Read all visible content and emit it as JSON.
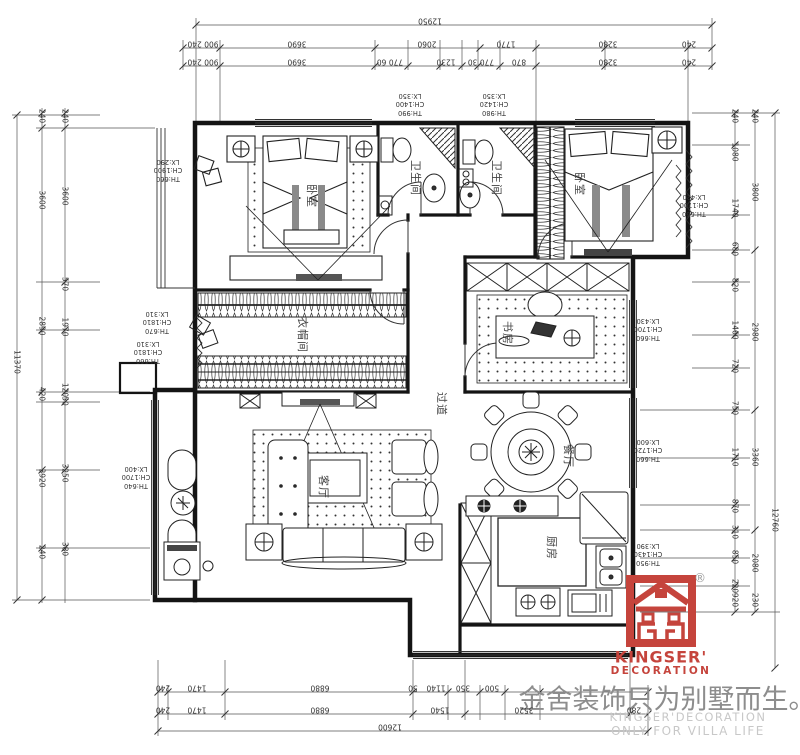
{
  "rooms": [
    {
      "label": "卧室",
      "x": 312,
      "y": 196
    },
    {
      "label": "卫生间",
      "x": 416,
      "y": 178
    },
    {
      "label": "卫生间",
      "x": 497,
      "y": 178
    },
    {
      "label": "卧室",
      "x": 580,
      "y": 184
    },
    {
      "label": "衣帽间",
      "x": 303,
      "y": 335
    },
    {
      "label": "过道",
      "x": 442,
      "y": 404
    },
    {
      "label": "书房",
      "x": 508,
      "y": 333
    },
    {
      "label": "客厅",
      "x": 324,
      "y": 487
    },
    {
      "label": "餐厅",
      "x": 569,
      "y": 456
    },
    {
      "label": "厨房",
      "x": 552,
      "y": 548
    }
  ],
  "annotations": [
    {
      "x": 168,
      "y": 170,
      "lines": [
        "TH:660",
        "CH:1900",
        "LX:290"
      ]
    },
    {
      "x": 410,
      "y": 104,
      "lines": [
        "TH:990",
        "CH:1400",
        "LX:350"
      ]
    },
    {
      "x": 494,
      "y": 104,
      "lines": [
        "TH:980",
        "CH:1420",
        "LX:350"
      ]
    },
    {
      "x": 694,
      "y": 205,
      "lines": [
        "TH:660",
        "CH:1700",
        "LX:420"
      ]
    },
    {
      "x": 157,
      "y": 322,
      "lines": [
        "TH:670",
        "CH:1810",
        "LX:310"
      ]
    },
    {
      "x": 148,
      "y": 352,
      "lines": [
        "TH:660",
        "CH:1810",
        "LX:310"
      ]
    },
    {
      "x": 648,
      "y": 329,
      "lines": [
        "TH:660",
        "CH:1700",
        "LX:430"
      ]
    },
    {
      "x": 136,
      "y": 477,
      "lines": [
        "TH:640",
        "CH:1700",
        "LX:400"
      ]
    },
    {
      "x": 648,
      "y": 450,
      "lines": [
        "TH:660",
        "CH:1720",
        "LX:600"
      ]
    },
    {
      "x": 648,
      "y": 554,
      "lines": [
        "TH:950",
        "CH:1430",
        "LX:390"
      ]
    }
  ],
  "dims": {
    "top": [
      {
        "t": "12950",
        "x": 430,
        "y": 21
      },
      {
        "t": "900 240",
        "x": 203,
        "y": 44
      },
      {
        "t": "3690",
        "x": 297,
        "y": 44
      },
      {
        "t": "2060",
        "x": 427,
        "y": 44
      },
      {
        "t": "1770",
        "x": 506,
        "y": 44
      },
      {
        "t": "3280",
        "x": 608,
        "y": 44
      },
      {
        "t": "240",
        "x": 689,
        "y": 44
      },
      {
        "t": "900 240",
        "x": 203,
        "y": 62
      },
      {
        "t": "3690",
        "x": 297,
        "y": 62
      },
      {
        "t": "770 60",
        "x": 390,
        "y": 62
      },
      {
        "t": "1230",
        "x": 446,
        "y": 62
      },
      {
        "t": "770 30",
        "x": 481,
        "y": 62
      },
      {
        "t": "870",
        "x": 519,
        "y": 62
      },
      {
        "t": "3280",
        "x": 608,
        "y": 62
      },
      {
        "t": "240",
        "x": 689,
        "y": 62
      }
    ],
    "bottom": [
      {
        "t": "12600",
        "x": 390,
        "y": 727
      },
      {
        "t": "240",
        "x": 163,
        "y": 688
      },
      {
        "t": "1470",
        "x": 197,
        "y": 688
      },
      {
        "t": "6880",
        "x": 320,
        "y": 688
      },
      {
        "t": "50",
        "x": 413,
        "y": 688
      },
      {
        "t": "1140",
        "x": 436,
        "y": 688
      },
      {
        "t": "350",
        "x": 463,
        "y": 688
      },
      {
        "t": "500",
        "x": 492,
        "y": 688
      },
      {
        "t": "240",
        "x": 163,
        "y": 710
      },
      {
        "t": "1470",
        "x": 197,
        "y": 710
      },
      {
        "t": "6880",
        "x": 320,
        "y": 710
      },
      {
        "t": "1540",
        "x": 440,
        "y": 710
      },
      {
        "t": "3520",
        "x": 524,
        "y": 710
      },
      {
        "t": "280",
        "x": 634,
        "y": 710
      }
    ],
    "left": [
      {
        "t": "11370",
        "x": 17,
        "y": 362
      },
      {
        "t": "240",
        "x": 42,
        "y": 116
      },
      {
        "t": "3600",
        "x": 42,
        "y": 200
      },
      {
        "t": "2890",
        "x": 42,
        "y": 326
      },
      {
        "t": "420",
        "x": 42,
        "y": 394
      },
      {
        "t": "3920",
        "x": 42,
        "y": 478
      },
      {
        "t": "240",
        "x": 42,
        "y": 552
      },
      {
        "t": "240",
        "x": 65,
        "y": 116
      },
      {
        "t": "3600",
        "x": 65,
        "y": 196
      },
      {
        "t": "570",
        "x": 65,
        "y": 284
      },
      {
        "t": "1970",
        "x": 65,
        "y": 327
      },
      {
        "t": "120",
        "x": 65,
        "y": 390
      },
      {
        "t": "50",
        "x": 65,
        "y": 401
      },
      {
        "t": "3250",
        "x": 65,
        "y": 473
      },
      {
        "t": "380",
        "x": 65,
        "y": 549
      }
    ],
    "right": [
      {
        "t": "12760",
        "x": 775,
        "y": 520
      },
      {
        "t": "240",
        "x": 755,
        "y": 116
      },
      {
        "t": "3800",
        "x": 755,
        "y": 192
      },
      {
        "t": "2980",
        "x": 755,
        "y": 332
      },
      {
        "t": "3360",
        "x": 755,
        "y": 457
      },
      {
        "t": "2080",
        "x": 755,
        "y": 563
      },
      {
        "t": "230",
        "x": 755,
        "y": 600
      },
      {
        "t": "240",
        "x": 735,
        "y": 116
      },
      {
        "t": "1080",
        "x": 735,
        "y": 152
      },
      {
        "t": "1740",
        "x": 735,
        "y": 208
      },
      {
        "t": "680",
        "x": 735,
        "y": 249
      },
      {
        "t": "820",
        "x": 735,
        "y": 285
      },
      {
        "t": "1460",
        "x": 735,
        "y": 330
      },
      {
        "t": "720",
        "x": 735,
        "y": 366
      },
      {
        "t": "750",
        "x": 735,
        "y": 408
      },
      {
        "t": "1710",
        "x": 735,
        "y": 457
      },
      {
        "t": "870",
        "x": 735,
        "y": 506
      },
      {
        "t": "310",
        "x": 735,
        "y": 532
      },
      {
        "t": "850",
        "x": 735,
        "y": 557
      },
      {
        "t": "220",
        "x": 735,
        "y": 586
      },
      {
        "t": "920",
        "x": 735,
        "y": 600
      }
    ]
  },
  "logo": {
    "registered": "®",
    "brand": "KINGSER'",
    "brand_sub": "DECORATION",
    "slogan": "金舍装饰只为别墅而生。",
    "footer_line1": "KINGSER'DECORATION",
    "footer_line2": "ONLY FOR VILLA LIFE"
  },
  "colors": {
    "brand_red": "#C5443C",
    "slogan_gray": "#8D8D8D",
    "footer_gray": "#C8C8C8",
    "ink": "#1A1A1A"
  }
}
